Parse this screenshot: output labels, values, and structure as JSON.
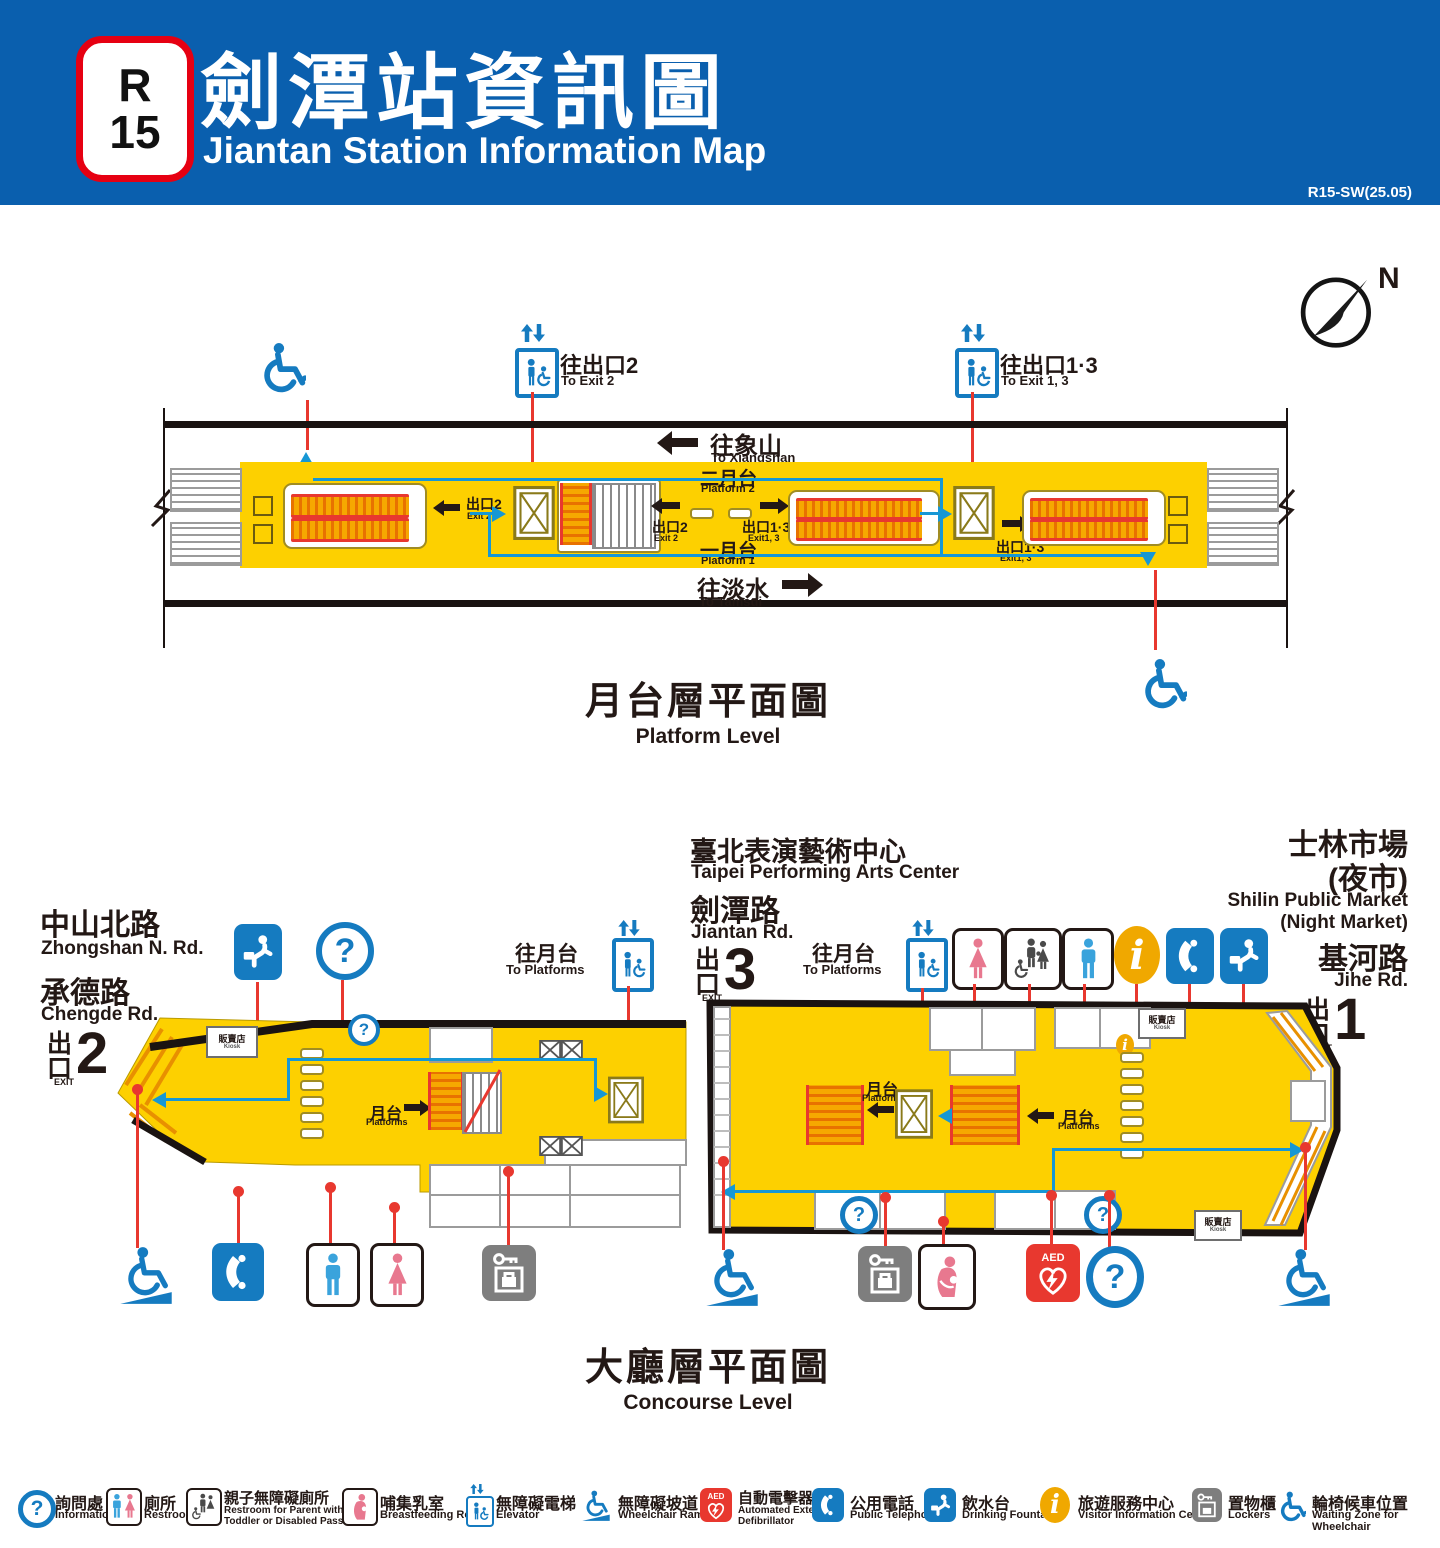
{
  "header": {
    "badge_line": "R",
    "badge_num": "15",
    "title_zh": "劍潭站資訊圖",
    "title_en": "Jiantan Station Information Map",
    "version": "R15-SW(25.05)"
  },
  "compass": {
    "north": "N"
  },
  "platform_level": {
    "title_zh": "月台層平面圖",
    "title_en": "Platform Level",
    "to_xiangshan_zh": "往象山",
    "to_xiangshan_en": "To Xiangshan",
    "to_tamsui_zh": "往淡水",
    "to_tamsui_en": "To Tamsui",
    "platform2_zh": "二月台",
    "platform2_en": "Platform 2",
    "platform1_zh": "一月台",
    "platform1_en": "Platform 1",
    "exit2_zh": "出口2",
    "exit2_en": "Exit 2",
    "exit13_zh": "出口1·3",
    "exit13_en": "Exit1, 3",
    "sign_exit2_zh": "往出口2",
    "sign_exit2_en": "To Exit 2",
    "sign_exit13_zh": "往出口1·3",
    "sign_exit13_en": "To Exit 1, 3"
  },
  "concourse": {
    "title_zh": "大廳層平面圖",
    "title_en": "Concourse Level",
    "to_platforms_zh": "往月台",
    "to_platforms_en": "To Platforms",
    "platforms_zh": "月台",
    "platforms_en": "Platforms",
    "kiosk_zh": "販賣店",
    "kiosk_en": "Kiosk",
    "exit_zh": "出口",
    "exit_en": "EXIT",
    "exit1_num": "1",
    "exit2_num": "2",
    "exit3_num": "3",
    "left": {
      "street1_zh": "中山北路",
      "street1_en": "Zhongshan N. Rd.",
      "street2_zh": "承德路",
      "street2_en": "Chengde Rd."
    },
    "right": {
      "poi_zh": "臺北表演藝術中心",
      "poi_en": "Taipei Performing Arts Center",
      "street1_zh": "劍潭路",
      "street1_en": "Jiantan Rd.",
      "market_zh1": "士林市場",
      "market_zh2": "(夜市)",
      "market_en1": "Shilin Public Market",
      "market_en2": "(Night Market)",
      "street2_zh": "基河路",
      "street2_en": "Jihe Rd."
    }
  },
  "legend": {
    "items": [
      {
        "zh": "詢問處",
        "en": "Information"
      },
      {
        "zh": "廁所",
        "en": "Restroom"
      },
      {
        "zh": "親子無障礙廁所",
        "en": "Restroom for Parent with",
        "en2": "Toddler or Disabled Passengers"
      },
      {
        "zh": "哺集乳室",
        "en": "Breastfeeding Room"
      },
      {
        "zh": "無障礙電梯",
        "en": "Elevator"
      },
      {
        "zh": "無障礙坡道",
        "en": "Wheelchair Ramp"
      },
      {
        "zh": "自動電擊器",
        "en": "Automated External",
        "en2": "Defibrillator"
      },
      {
        "zh": "公用電話",
        "en": "Public Telephone"
      },
      {
        "zh": "飲水台",
        "en": "Drinking Fountain"
      },
      {
        "zh": "旅遊服務中心",
        "en": "Visitor Information Center"
      },
      {
        "zh": "置物櫃",
        "en": "Lockers"
      },
      {
        "zh": "輪椅候車位置",
        "en": "Waiting Zone for Wheelchair"
      }
    ]
  },
  "glyphs": {
    "question": "?",
    "aed": "AED",
    "info_i": "i"
  }
}
